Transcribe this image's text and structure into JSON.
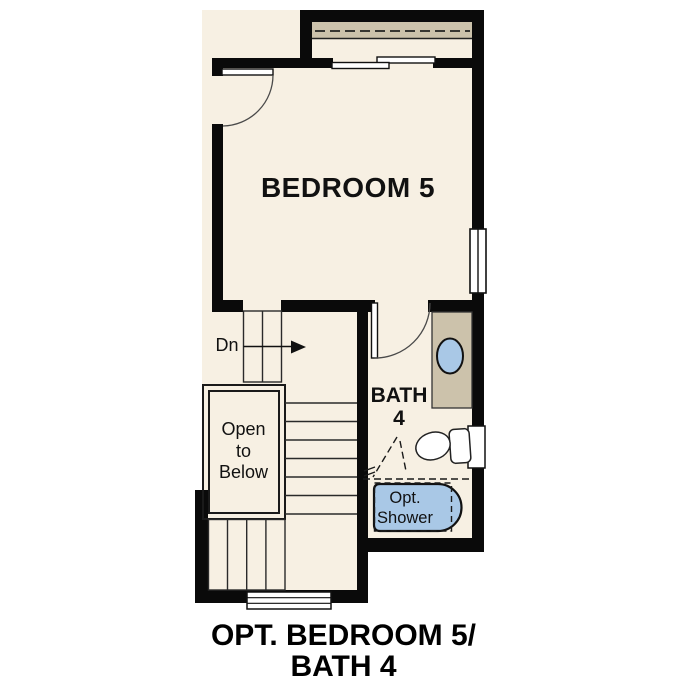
{
  "floorplan": {
    "labels": {
      "bedroom": "BEDROOM 5",
      "bath_line1": "BATH",
      "bath_line2": "4",
      "stair_direction": "Dn",
      "open_to_below_line1": "Open",
      "open_to_below_line2": "to",
      "open_to_below_line3": "Below",
      "opt_shower_line1": "Opt.",
      "opt_shower_line2": "Shower"
    },
    "caption": {
      "line1": "OPT. BEDROOM 5/",
      "line2": "BATH 4"
    },
    "colors": {
      "page_background": "#ffffff",
      "floor": "#f7f0e3",
      "walls": "#0a0a0a",
      "millwork_tan": "#ccc2ab",
      "plumbing_blue": "#a9c8e6",
      "linework": "#3a3a3a",
      "text": "#111111"
    }
  }
}
